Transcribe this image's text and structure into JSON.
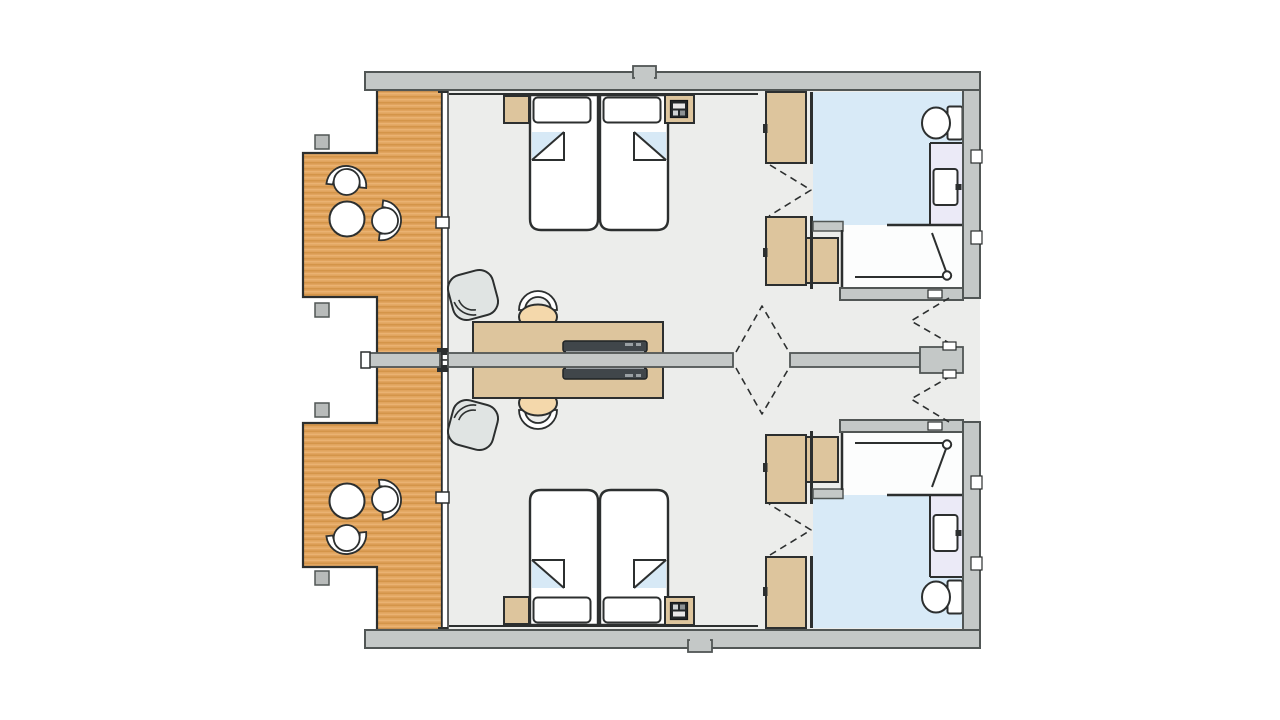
{
  "meta": {
    "type": "architectural-floor-plan",
    "description": "Top-view floor plan of two mirrored hotel guest rooms separated by a central party wall, each with balcony, twin beds, desk, wardrobes and en-suite bathroom"
  },
  "palette": {
    "background": "#ffffff",
    "wall_fill": "#c4c8c7",
    "wall_outline": "#515655",
    "line": "#2c2f2f",
    "floor": "#ecedeb",
    "wood": "#e1a45e",
    "wood_stripe": "#d49549",
    "wood_stripe_light": "#ecb677",
    "furniture_tan": "#ddc59d",
    "bathroom_floor": "#d8eaf7",
    "vanity_floor": "#ebeaf7",
    "shower_floor": "#fcfdfd",
    "chair_peach": "#f4d8ab",
    "chair_gray": "#e0e4e3",
    "laptop_dark": "#40464a",
    "laptop_light": "#9aa0a3",
    "post_gray": "#b8bbba",
    "fold_blue": "#d7e9f6",
    "glass_white": "#ffffff",
    "phone_dark": "#23282a"
  },
  "scene": {
    "units": [
      {
        "name": "guest-room-top",
        "bedroom_furniture": [
          "twin-bed-left",
          "twin-bed-right",
          "nightstand-left",
          "nightstand-right-with-phone",
          "desk",
          "laptop",
          "task-chair",
          "lounge-chair"
        ],
        "storage": [
          "wardrobe-upper",
          "wardrobe-lower",
          "minibar-cabinet"
        ],
        "bathroom_fixtures": [
          "toilet",
          "vanity-with-sink",
          "walk-in-shower"
        ],
        "balcony_furniture": [
          "round-table",
          "tub-chair-1",
          "tub-chair-2"
        ]
      },
      {
        "name": "guest-room-bottom",
        "mirrored_copy_of": "guest-room-top"
      }
    ],
    "doors": [
      "connecting-double-door-center",
      "entry-door-top-room",
      "entry-door-bottom-room",
      "bathroom-folding-door-per-room",
      "balcony-glass-facade-per-room"
    ]
  }
}
